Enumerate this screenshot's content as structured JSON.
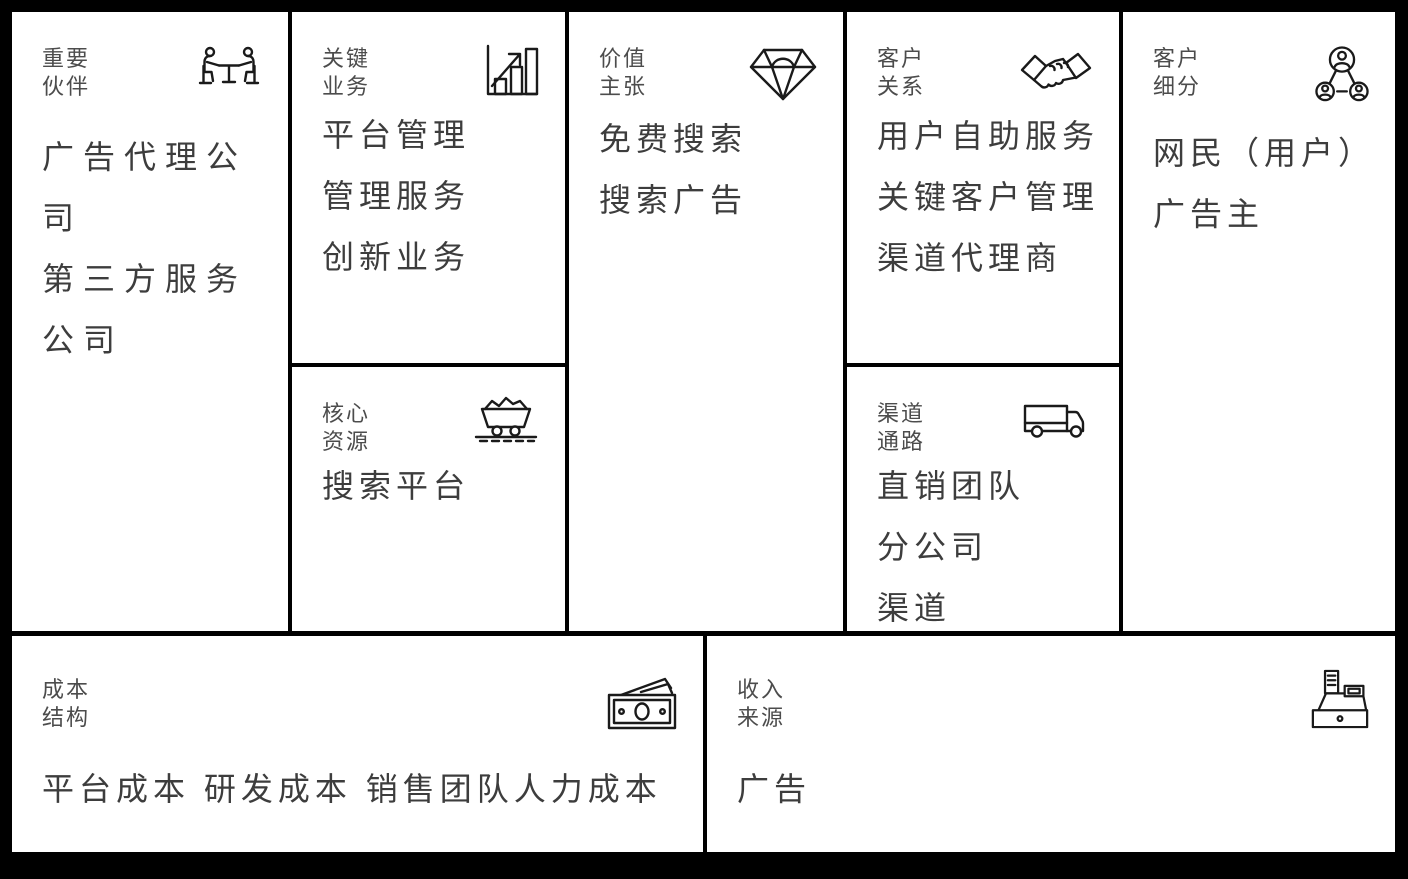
{
  "canvas": {
    "background": "#000000",
    "cell_background": "#ffffff",
    "label_color": "#4c4c4c",
    "text_color": "#3d3d3d",
    "icon_color": "#1a1a1a"
  },
  "cells": {
    "key_partners": {
      "label": [
        "重要",
        "伙伴"
      ],
      "icon": "meeting-icon",
      "items": [
        "广告代理公司",
        "第三方服务公司"
      ]
    },
    "key_activities": {
      "label": [
        "关键",
        "业务"
      ],
      "icon": "bar-chart-icon",
      "items": [
        "平台管理",
        "管理服务",
        "创新业务"
      ]
    },
    "key_resources": {
      "label": [
        "核心",
        "资源"
      ],
      "icon": "minecart-icon",
      "items": [
        "搜索平台"
      ]
    },
    "value_proposition": {
      "label": [
        "价值",
        "主张"
      ],
      "icon": "diamond-icon",
      "items": [
        "免费搜索",
        "搜索广告"
      ]
    },
    "customer_relationships": {
      "label": [
        "客户",
        "关系"
      ],
      "icon": "handshake-icon",
      "items": [
        "用户自助服务",
        "关键客户管理",
        "渠道代理商"
      ]
    },
    "channels": {
      "label": [
        "渠道",
        "通路"
      ],
      "icon": "truck-icon",
      "items": [
        "直销团队",
        "分公司",
        "渠道"
      ]
    },
    "customer_segments": {
      "label": [
        "客户",
        "细分"
      ],
      "icon": "network-people-icon",
      "items": [
        "网民（用户）",
        "广告主"
      ]
    },
    "cost_structure": {
      "label": [
        "成本",
        "结构"
      ],
      "icon": "banknotes-icon",
      "items": [
        "平台成本 研发成本 销售团队人力成本"
      ]
    },
    "revenue_streams": {
      "label": [
        "收入",
        "来源"
      ],
      "icon": "cash-register-icon",
      "items": [
        "广告"
      ]
    }
  }
}
